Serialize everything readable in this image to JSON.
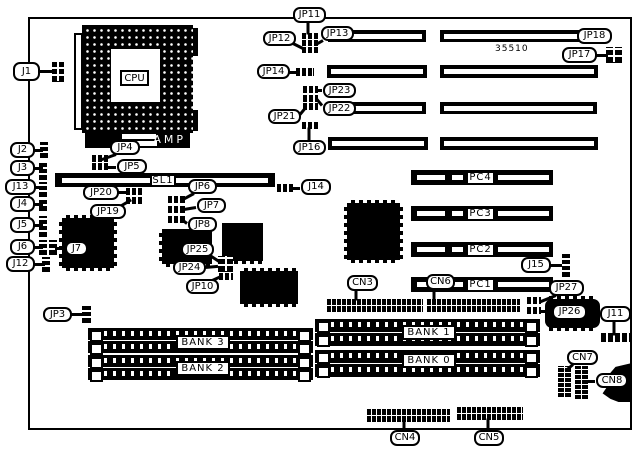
{
  "board": {
    "code": "35510",
    "x": 28,
    "y": 17,
    "w": 604,
    "h": 413,
    "ink": "#000000",
    "paper": "#ffffff"
  },
  "cpu": {
    "label": "CPU",
    "brand": "AMP"
  },
  "callouts": [
    {
      "name": "j1",
      "text": "J1",
      "x": 13,
      "y": 62,
      "w": 27,
      "h": 19,
      "ptr": [
        [
          40,
          71,
          54,
          71
        ]
      ]
    },
    {
      "name": "j2",
      "text": "J2",
      "x": 10,
      "y": 142,
      "w": 25,
      "h": 16,
      "ptr": [
        [
          34,
          150,
          42,
          150
        ]
      ]
    },
    {
      "name": "j3",
      "text": "J3",
      "x": 10,
      "y": 160,
      "w": 25,
      "h": 16,
      "ptr": [
        [
          34,
          168,
          42,
          168
        ]
      ]
    },
    {
      "name": "j13",
      "text": "J13",
      "x": 5,
      "y": 179,
      "w": 31,
      "h": 16,
      "ptr": [
        [
          35,
          187,
          42,
          187
        ]
      ]
    },
    {
      "name": "j4",
      "text": "J4",
      "x": 10,
      "y": 196,
      "w": 25,
      "h": 16,
      "ptr": [
        [
          34,
          204,
          42,
          204
        ]
      ]
    },
    {
      "name": "j5",
      "text": "J5",
      "x": 10,
      "y": 217,
      "w": 25,
      "h": 16,
      "ptr": [
        [
          34,
          225,
          42,
          225
        ]
      ]
    },
    {
      "name": "j6",
      "text": "J6",
      "x": 10,
      "y": 239,
      "w": 25,
      "h": 16,
      "ptr": [
        [
          34,
          247,
          42,
          247
        ]
      ]
    },
    {
      "name": "j12",
      "text": "J12",
      "x": 6,
      "y": 256,
      "w": 29,
      "h": 16,
      "ptr": [
        [
          34,
          264,
          44,
          264
        ]
      ]
    },
    {
      "name": "j7",
      "text": "J7",
      "x": 65,
      "y": 241,
      "w": 23,
      "h": 15,
      "ptr": [
        [
          64,
          248,
          56,
          248
        ]
      ]
    },
    {
      "name": "jp4",
      "text": "JP4",
      "x": 110,
      "y": 140,
      "w": 30,
      "h": 15,
      "ptr": [
        [
          116,
          154,
          102,
          159
        ]
      ]
    },
    {
      "name": "jp5",
      "text": "JP5",
      "x": 117,
      "y": 159,
      "w": 30,
      "h": 15,
      "ptr": [
        [
          116,
          167,
          107,
          167
        ]
      ]
    },
    {
      "name": "jp20",
      "text": "JP20",
      "x": 83,
      "y": 185,
      "w": 36,
      "h": 15,
      "ptr": [
        [
          118,
          192,
          127,
          192
        ]
      ]
    },
    {
      "name": "jp19",
      "text": "JP19",
      "x": 90,
      "y": 204,
      "w": 36,
      "h": 15,
      "ptr": [
        [
          120,
          206,
          130,
          200
        ]
      ]
    },
    {
      "name": "jp6",
      "text": "JP6",
      "x": 188,
      "y": 179,
      "w": 29,
      "h": 15,
      "ptr": [
        [
          194,
          193,
          183,
          199
        ]
      ]
    },
    {
      "name": "jp7",
      "text": "JP7",
      "x": 197,
      "y": 198,
      "w": 29,
      "h": 15,
      "ptr": [
        [
          196,
          207,
          184,
          209
        ]
      ]
    },
    {
      "name": "jp8",
      "text": "JP8",
      "x": 188,
      "y": 217,
      "w": 29,
      "h": 15,
      "ptr": [
        [
          187,
          223,
          183,
          220
        ]
      ]
    },
    {
      "name": "jp25",
      "text": "JP25",
      "x": 181,
      "y": 242,
      "w": 33,
      "h": 15,
      "ptr": [
        [
          210,
          255,
          219,
          261
        ]
      ]
    },
    {
      "name": "jp24",
      "text": "JP24",
      "x": 173,
      "y": 260,
      "w": 33,
      "h": 15,
      "ptr": [
        [
          205,
          267,
          217,
          266
        ]
      ]
    },
    {
      "name": "jp10",
      "text": "JP10",
      "x": 186,
      "y": 279,
      "w": 33,
      "h": 15,
      "ptr": [
        [
          210,
          281,
          221,
          276
        ]
      ]
    },
    {
      "name": "jp3",
      "text": "JP3",
      "x": 43,
      "y": 307,
      "w": 29,
      "h": 15,
      "ptr": [
        [
          71,
          314,
          82,
          314
        ]
      ]
    },
    {
      "name": "j14",
      "text": "J14",
      "x": 301,
      "y": 179,
      "w": 30,
      "h": 16,
      "ptr": [
        [
          300,
          188,
          292,
          188
        ]
      ]
    },
    {
      "name": "jp11",
      "text": "JP11",
      "x": 293,
      "y": 7,
      "w": 33,
      "h": 16,
      "ptr": [
        [
          308,
          22,
          308,
          33
        ]
      ]
    },
    {
      "name": "jp12",
      "text": "JP12",
      "x": 263,
      "y": 31,
      "w": 33,
      "h": 15,
      "ptr": [
        [
          293,
          43,
          303,
          48
        ]
      ]
    },
    {
      "name": "jp13",
      "text": "JP13",
      "x": 321,
      "y": 26,
      "w": 33,
      "h": 15,
      "ptr": [
        [
          323,
          40,
          316,
          44
        ]
      ]
    },
    {
      "name": "jp14",
      "text": "JP14",
      "x": 257,
      "y": 64,
      "w": 33,
      "h": 15,
      "ptr": [
        [
          289,
          72,
          297,
          72
        ]
      ]
    },
    {
      "name": "jp23",
      "text": "JP23",
      "x": 323,
      "y": 83,
      "w": 33,
      "h": 15,
      "ptr": [
        [
          322,
          90,
          317,
          90
        ]
      ]
    },
    {
      "name": "jp22",
      "text": "JP22",
      "x": 323,
      "y": 101,
      "w": 33,
      "h": 15,
      "ptr": [
        [
          322,
          105,
          317,
          99
        ]
      ]
    },
    {
      "name": "jp21",
      "text": "JP21",
      "x": 268,
      "y": 109,
      "w": 33,
      "h": 15,
      "ptr": [
        [
          300,
          114,
          305,
          108
        ]
      ]
    },
    {
      "name": "jp16",
      "text": "JP16",
      "x": 293,
      "y": 140,
      "w": 33,
      "h": 15,
      "ptr": [
        [
          309,
          141,
          309,
          128
        ]
      ]
    },
    {
      "name": "jp18",
      "text": "JP18",
      "x": 577,
      "y": 28,
      "w": 35,
      "h": 16
    },
    {
      "name": "jp17",
      "text": "JP17",
      "x": 562,
      "y": 47,
      "w": 35,
      "h": 16,
      "ptr": [
        [
          596,
          55,
          607,
          55
        ]
      ]
    },
    {
      "name": "j15",
      "text": "J15",
      "x": 521,
      "y": 257,
      "w": 30,
      "h": 16,
      "ptr": [
        [
          550,
          265,
          561,
          265
        ]
      ]
    },
    {
      "name": "jp27",
      "text": "JP27",
      "x": 549,
      "y": 280,
      "w": 35,
      "h": 16,
      "ptr": [
        [
          556,
          295,
          541,
          301
        ]
      ]
    },
    {
      "name": "jp26",
      "text": "JP26",
      "x": 552,
      "y": 304,
      "w": 35,
      "h": 16,
      "ptr": [
        [
          551,
          311,
          542,
          311
        ]
      ]
    },
    {
      "name": "j11",
      "text": "J11",
      "x": 600,
      "y": 306,
      "w": 31,
      "h": 16,
      "ptr": [
        [
          614,
          321,
          614,
          334
        ]
      ]
    },
    {
      "name": "cn3",
      "text": "CN3",
      "x": 347,
      "y": 275,
      "w": 31,
      "h": 16,
      "ptr": [
        [
          356,
          290,
          356,
          299
        ]
      ]
    },
    {
      "name": "cn6",
      "text": "CN6",
      "x": 426,
      "y": 274,
      "w": 29,
      "h": 16,
      "ptr": [
        [
          434,
          289,
          434,
          299
        ]
      ]
    },
    {
      "name": "cn7",
      "text": "CN7",
      "x": 567,
      "y": 350,
      "w": 31,
      "h": 15,
      "ptr": [
        [
          573,
          364,
          566,
          370
        ]
      ]
    },
    {
      "name": "cn8",
      "text": "CN8",
      "x": 596,
      "y": 373,
      "w": 32,
      "h": 15,
      "ptr": [
        [
          595,
          381,
          588,
          381
        ]
      ]
    },
    {
      "name": "cn4",
      "text": "CN4",
      "x": 390,
      "y": 430,
      "w": 30,
      "h": 16,
      "ptr": [
        [
          404,
          429,
          404,
          421
        ]
      ]
    },
    {
      "name": "cn5",
      "text": "CN5",
      "x": 474,
      "y": 430,
      "w": 30,
      "h": 16,
      "ptr": [
        [
          488,
          429,
          488,
          419
        ]
      ]
    },
    {
      "name": "sl1",
      "text": "SL1",
      "x": 150,
      "y": 174,
      "w": 26,
      "h": 13,
      "sq": 1
    },
    {
      "name": "pc4",
      "text": "PC4",
      "x": 466,
      "y": 171,
      "w": 29,
      "h": 14,
      "sq": 1
    },
    {
      "name": "pc3",
      "text": "PC3",
      "x": 466,
      "y": 207,
      "w": 29,
      "h": 14,
      "sq": 1
    },
    {
      "name": "pc2",
      "text": "PC2",
      "x": 466,
      "y": 243,
      "w": 29,
      "h": 14,
      "sq": 1
    },
    {
      "name": "pc1",
      "text": "PC1",
      "x": 466,
      "y": 278,
      "w": 29,
      "h": 14,
      "sq": 1
    },
    {
      "name": "bank3",
      "text": "BANK 3",
      "x": 176,
      "y": 335,
      "w": 54,
      "h": 15,
      "sq": 1
    },
    {
      "name": "bank2",
      "text": "BANK 2",
      "x": 176,
      "y": 361,
      "w": 54,
      "h": 15,
      "sq": 1
    },
    {
      "name": "bank1",
      "text": "BANK 1",
      "x": 402,
      "y": 325,
      "w": 54,
      "h": 15,
      "sq": 1
    },
    {
      "name": "bank0",
      "text": "BANK 0",
      "x": 402,
      "y": 353,
      "w": 54,
      "h": 15,
      "sq": 1
    }
  ],
  "slots": [
    {
      "name": "isa-slot-1-left",
      "x": 328,
      "y": 30,
      "w": 98,
      "h": 12
    },
    {
      "name": "isa-slot-1-right",
      "x": 440,
      "y": 30,
      "w": 158,
      "h": 12
    },
    {
      "name": "isa-slot-2-left",
      "x": 327,
      "y": 65,
      "w": 100,
      "h": 13
    },
    {
      "name": "isa-slot-2-right",
      "x": 440,
      "y": 65,
      "w": 158,
      "h": 13
    },
    {
      "name": "isa-slot-3-left",
      "x": 328,
      "y": 102,
      "w": 98,
      "h": 12
    },
    {
      "name": "isa-slot-3-right",
      "x": 440,
      "y": 102,
      "w": 157,
      "h": 12
    },
    {
      "name": "isa-slot-4-left",
      "x": 328,
      "y": 137,
      "w": 100,
      "h": 13
    },
    {
      "name": "isa-slot-4-right",
      "x": 440,
      "y": 137,
      "w": 158,
      "h": 13
    },
    {
      "name": "sl1-slot",
      "x": 55,
      "y": 173,
      "w": 220,
      "h": 14,
      "stripes": [
        [
          7,
          206
        ]
      ]
    },
    {
      "name": "pci-slot-pc4",
      "x": 411,
      "y": 170,
      "w": 142,
      "h": 15,
      "stripes": [
        [
          6,
          28
        ],
        [
          41,
          11
        ],
        [
          87,
          51
        ]
      ]
    },
    {
      "name": "pci-slot-pc3",
      "x": 411,
      "y": 206,
      "w": 142,
      "h": 15,
      "stripes": [
        [
          6,
          28
        ],
        [
          41,
          11
        ],
        [
          87,
          51
        ]
      ]
    },
    {
      "name": "pci-slot-pc2",
      "x": 411,
      "y": 242,
      "w": 142,
      "h": 15,
      "stripes": [
        [
          6,
          28
        ],
        [
          41,
          11
        ],
        [
          87,
          51
        ]
      ]
    },
    {
      "name": "pci-slot-pc1",
      "x": 411,
      "y": 277,
      "w": 142,
      "h": 15,
      "stripes": [
        [
          6,
          28
        ],
        [
          41,
          11
        ],
        [
          87,
          51
        ]
      ]
    }
  ],
  "simm_slots": [
    {
      "name": "simm-bank3-a",
      "x": 88,
      "y": 328,
      "w": 225,
      "h": 12
    },
    {
      "name": "simm-bank3-b",
      "x": 88,
      "y": 341,
      "w": 225,
      "h": 12
    },
    {
      "name": "simm-bank2-a",
      "x": 88,
      "y": 355,
      "w": 225,
      "h": 12
    },
    {
      "name": "simm-bank2-b",
      "x": 88,
      "y": 368,
      "w": 225,
      "h": 12
    },
    {
      "name": "simm-bank1-a",
      "x": 315,
      "y": 319,
      "w": 225,
      "h": 13
    },
    {
      "name": "simm-bank1-b",
      "x": 315,
      "y": 333,
      "w": 225,
      "h": 13
    },
    {
      "name": "simm-bank0-a",
      "x": 315,
      "y": 350,
      "w": 225,
      "h": 13
    },
    {
      "name": "simm-bank0-b",
      "x": 315,
      "y": 364,
      "w": 225,
      "h": 13
    }
  ],
  "jumpers": [
    {
      "name": "j1-jumper",
      "x": 52,
      "y": 62,
      "w": 12,
      "h": 20,
      "o": "g"
    },
    {
      "name": "j2-jumper",
      "x": 40,
      "y": 142,
      "w": 8,
      "h": 16,
      "o": "v"
    },
    {
      "name": "j3-jumper",
      "x": 39,
      "y": 161,
      "w": 8,
      "h": 19,
      "o": "v"
    },
    {
      "name": "j13-jumper",
      "x": 39,
      "y": 182,
      "w": 8,
      "h": 15,
      "o": "v"
    },
    {
      "name": "j4-jumper",
      "x": 39,
      "y": 198,
      "w": 8,
      "h": 13,
      "o": "v"
    },
    {
      "name": "j5-jumper",
      "x": 39,
      "y": 216,
      "w": 8,
      "h": 21,
      "o": "v"
    },
    {
      "name": "j6-jumper",
      "x": 39,
      "y": 240,
      "w": 8,
      "h": 15,
      "o": "v"
    },
    {
      "name": "j7-jumper",
      "x": 49,
      "y": 240,
      "w": 8,
      "h": 15,
      "o": "v"
    },
    {
      "name": "j12-jumper",
      "x": 42,
      "y": 257,
      "w": 8,
      "h": 15,
      "o": "v"
    },
    {
      "name": "jp4-jumper",
      "x": 92,
      "y": 155,
      "w": 16,
      "h": 7,
      "o": "h"
    },
    {
      "name": "jp5-jumper",
      "x": 92,
      "y": 163,
      "w": 16,
      "h": 7,
      "o": "h"
    },
    {
      "name": "jp20-jumper",
      "x": 126,
      "y": 188,
      "w": 16,
      "h": 7,
      "o": "h"
    },
    {
      "name": "jp19-jumper",
      "x": 126,
      "y": 197,
      "w": 16,
      "h": 7,
      "o": "h"
    },
    {
      "name": "jp6-jumper",
      "x": 168,
      "y": 196,
      "w": 17,
      "h": 7,
      "o": "h"
    },
    {
      "name": "jp7-jumper",
      "x": 168,
      "y": 206,
      "w": 17,
      "h": 7,
      "o": "h"
    },
    {
      "name": "jp8-jumper",
      "x": 168,
      "y": 216,
      "w": 17,
      "h": 7,
      "o": "h"
    },
    {
      "name": "jp11-jumper-a",
      "x": 302,
      "y": 33,
      "w": 16,
      "h": 6,
      "o": "h"
    },
    {
      "name": "jp11-jumper-b",
      "x": 302,
      "y": 40,
      "w": 16,
      "h": 6,
      "o": "h"
    },
    {
      "name": "jp11-jumper-c",
      "x": 302,
      "y": 47,
      "w": 16,
      "h": 6,
      "o": "h"
    },
    {
      "name": "jp14-jumper",
      "x": 296,
      "y": 68,
      "w": 18,
      "h": 8,
      "o": "h"
    },
    {
      "name": "jp23-jumper",
      "x": 303,
      "y": 86,
      "w": 15,
      "h": 7,
      "o": "h"
    },
    {
      "name": "jp22-jumper",
      "x": 303,
      "y": 95,
      "w": 15,
      "h": 7,
      "o": "h"
    },
    {
      "name": "jp21-jumper",
      "x": 303,
      "y": 103,
      "w": 15,
      "h": 7,
      "o": "h"
    },
    {
      "name": "jp16-jumper",
      "x": 302,
      "y": 122,
      "w": 16,
      "h": 7,
      "o": "h"
    },
    {
      "name": "j14-jumper",
      "x": 277,
      "y": 184,
      "w": 16,
      "h": 8,
      "o": "h"
    },
    {
      "name": "jp17-jumper",
      "x": 606,
      "y": 47,
      "w": 16,
      "h": 16,
      "o": "g"
    },
    {
      "name": "jp24-jp25-block",
      "x": 218,
      "y": 256,
      "w": 15,
      "h": 16,
      "o": "g"
    },
    {
      "name": "jp10-jumper",
      "x": 219,
      "y": 273,
      "w": 14,
      "h": 7,
      "o": "h"
    },
    {
      "name": "jp3-jumper",
      "x": 82,
      "y": 306,
      "w": 9,
      "h": 17,
      "o": "v"
    },
    {
      "name": "j15-jumper",
      "x": 562,
      "y": 252,
      "w": 8,
      "h": 25,
      "o": "v"
    },
    {
      "name": "jp27-jumper-a",
      "x": 527,
      "y": 297,
      "w": 14,
      "h": 7,
      "o": "h"
    },
    {
      "name": "jp27-jumper-b",
      "x": 527,
      "y": 307,
      "w": 14,
      "h": 7,
      "o": "h"
    }
  ],
  "headers": [
    {
      "name": "cn3-header",
      "x": 327,
      "y": 298,
      "w": 96,
      "h": 14,
      "o": "h2"
    },
    {
      "name": "cn6-header",
      "x": 427,
      "y": 298,
      "w": 93,
      "h": 14,
      "o": "h2"
    },
    {
      "name": "cn4-header",
      "x": 367,
      "y": 408,
      "w": 83,
      "h": 14,
      "o": "h2"
    },
    {
      "name": "cn5-header",
      "x": 457,
      "y": 406,
      "w": 66,
      "h": 14,
      "o": "h2"
    },
    {
      "name": "cn7-header",
      "x": 558,
      "y": 366,
      "w": 14,
      "h": 31,
      "o": "v2"
    },
    {
      "name": "cn8-header",
      "x": 575,
      "y": 366,
      "w": 14,
      "h": 33,
      "o": "v2"
    },
    {
      "name": "j11-header",
      "x": 601,
      "y": 333,
      "w": 30,
      "h": 9,
      "o": "h1"
    }
  ],
  "chips": [
    {
      "name": "qfp-chip-1",
      "x": 62,
      "y": 218,
      "w": 52,
      "h": 50,
      "pins": "tblr"
    },
    {
      "name": "qfp-chip-2",
      "x": 162,
      "y": 229,
      "w": 50,
      "h": 35,
      "pins": "bl"
    },
    {
      "name": "chip-3",
      "x": 222,
      "y": 223,
      "w": 41,
      "h": 38,
      "pins": "b"
    },
    {
      "name": "chip-4",
      "x": 240,
      "y": 271,
      "w": 58,
      "h": 33,
      "pins": "tb"
    },
    {
      "name": "qfp-chip-5",
      "x": 347,
      "y": 203,
      "w": 53,
      "h": 57,
      "pins": "tblr"
    },
    {
      "name": "chip-6",
      "x": 545,
      "y": 299,
      "w": 55,
      "h": 29,
      "pins": "tb",
      "round": 1
    }
  ]
}
